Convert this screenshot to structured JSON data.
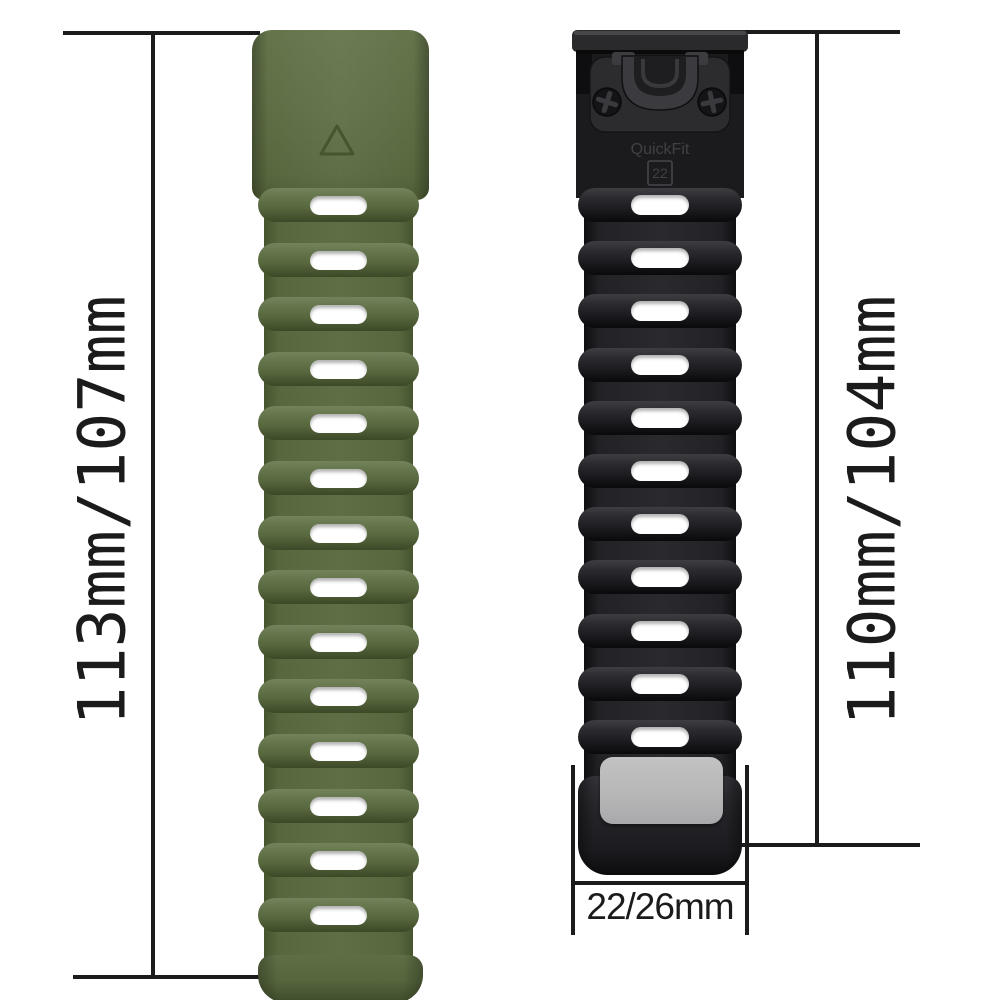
{
  "product": {
    "left_band": {
      "color_name": "army-green",
      "length_label": "113mm/107mm",
      "hole_count": 14,
      "base_color": "#5e6e45"
    },
    "right_band": {
      "color_name": "black",
      "length_label": "110mm/104mm",
      "hole_count": 11,
      "base_color": "#222226"
    },
    "width_label": "22/26mm",
    "connector": {
      "brand": "QuickFit",
      "lug_size": "22"
    }
  },
  "colors": {
    "background": "#ffffff",
    "measurement_line": "#1b1b1b",
    "hole": "#ffffff",
    "keeper_pad": "#b7b7b8"
  }
}
